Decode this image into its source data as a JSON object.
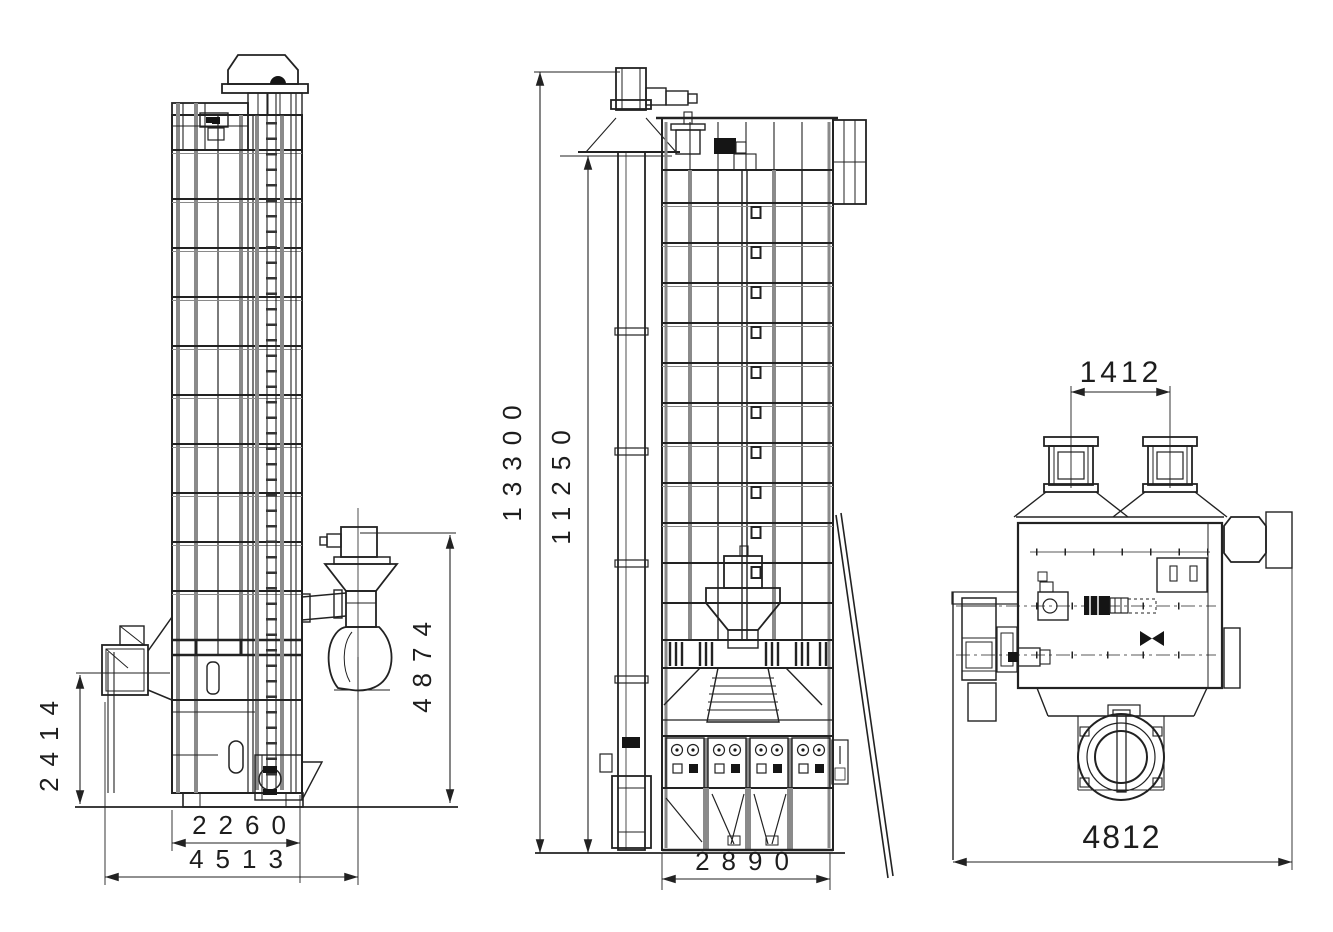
{
  "drawing": {
    "background_color": "#ffffff",
    "line_color": "#222222",
    "views": {
      "side_view": {
        "name": "left side elevation of grain dryer",
        "dims": {
          "fan_axis_height": "2414",
          "cyclone_top_height": "4874",
          "body_depth": "2260",
          "overall_depth": "4513"
        }
      },
      "front_view": {
        "name": "front elevation of grain dryer",
        "dims": {
          "overall_height": "13300",
          "tower_height": "11250",
          "tower_width": "2890"
        }
      },
      "plan_view": {
        "name": "top plan view of grain dryer",
        "dims": {
          "hopper_pitch": "1412",
          "overall_width": "4812"
        }
      }
    }
  }
}
